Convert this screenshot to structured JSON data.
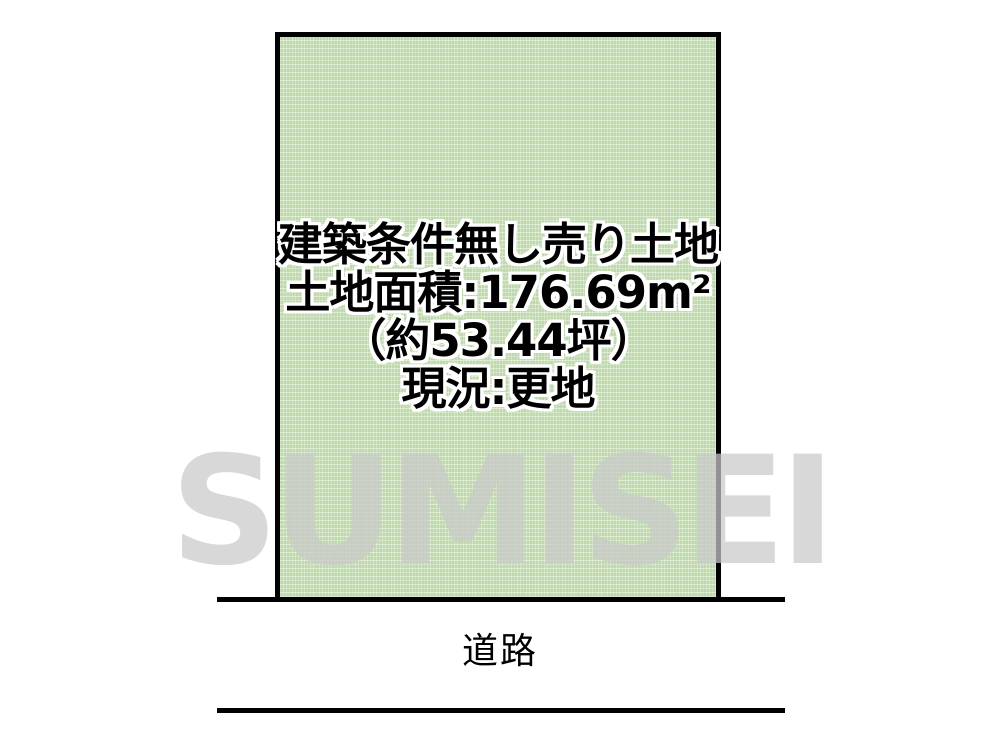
{
  "parcel": {
    "label_lines": [
      "建築条件無し売り土地",
      "土地面積:176.69m²",
      "（約53.44坪）",
      "現況:更地"
    ],
    "area_sqm": "176.69",
    "area_tsubo": "53.44",
    "fill_color": "#bedaaa",
    "border_color": "#000000",
    "text_color": "#000000",
    "text_outline_color": "#ffffff"
  },
  "road": {
    "label": "道路"
  },
  "watermark": {
    "text": "SUMISEI",
    "color": "#c9c9c9"
  }
}
